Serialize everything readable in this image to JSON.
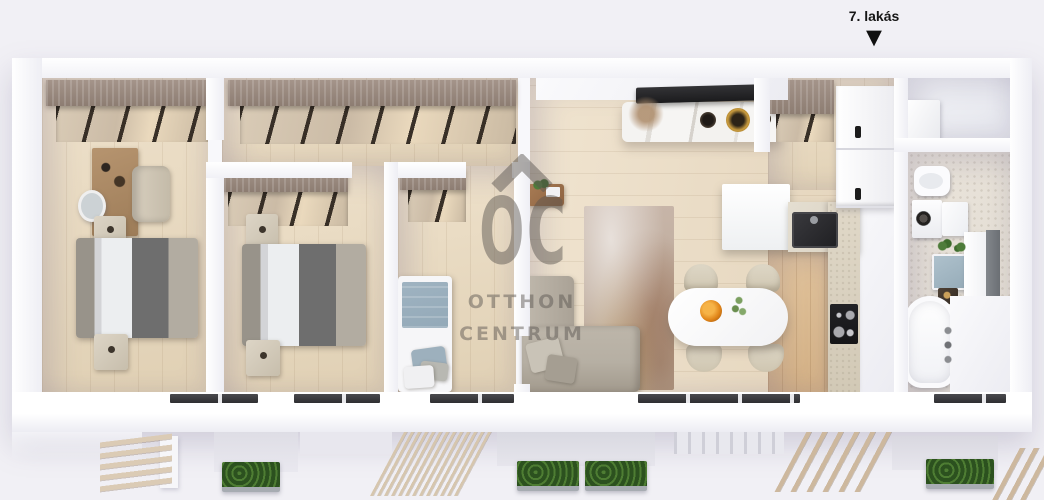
{
  "unit": {
    "label": "7. lakás",
    "marker_glyph": "▼"
  },
  "watermark": {
    "initials": "OC",
    "line1": "OTTHON",
    "line2": "CENTRUM"
  },
  "colors": {
    "background": "#f1f0f5",
    "wall": "#fbfbfd",
    "floor_wood": "#e9ddc7",
    "floor_oak": "#e2c49c",
    "wardrobe_wood": "#a4948a",
    "duvet": "#eceef0",
    "throw": "#6e6e6e",
    "bed_blue": "#93a9b8",
    "sofa": "#b6afa3",
    "rug_base": "#c7b5a8",
    "marble": "#f4f3f1",
    "tv": "#1b1b1d",
    "stone": "#dad2c2",
    "appliance": "#1f1f22",
    "planter_green": "#2c511f",
    "slat_wood": "#dbcbb5",
    "watermark": "#5b5651",
    "label": "#161616"
  },
  "scene": {
    "type": "apartment-3d-floorplan-top-view",
    "rooms": [
      "bedroom-1",
      "bedroom-2",
      "bedroom-3",
      "corridor",
      "living-room",
      "dining-kitchen",
      "entry-hall",
      "utility-room",
      "bathroom",
      "terrace"
    ]
  }
}
